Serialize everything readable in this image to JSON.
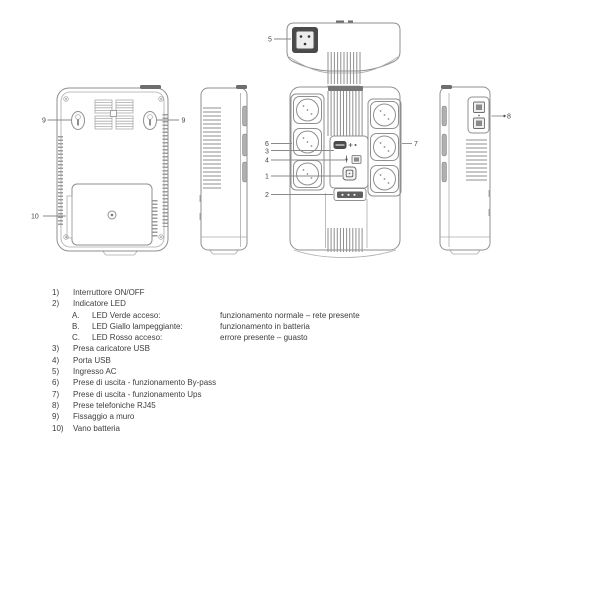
{
  "page": {
    "background": "#ffffff",
    "line_color": "#8f8f8f",
    "dark_fill": "#6e6e6e",
    "text_color": "#3e3e3e"
  },
  "callouts": {
    "power_switch": "1",
    "led_indicator": "2",
    "usb_charger": "3",
    "usb_port": "4",
    "ac_input": "5",
    "bypass_outlets": "6",
    "ups_outlets": "7",
    "rj45": "8",
    "wall_mount_left": "9",
    "wall_mount_right": "9",
    "battery_bay": "10"
  },
  "legend": {
    "items": [
      {
        "num": "1)",
        "text": "Interruttore ON/OFF"
      },
      {
        "num": "2)",
        "text": "Indicatore LED"
      },
      {
        "num": "3)",
        "text": "Presa caricatore USB"
      },
      {
        "num": "4)",
        "text": "Porta USB"
      },
      {
        "num": "5)",
        "text": "Ingresso AC"
      },
      {
        "num": "6)",
        "text": "Prese di uscita - funzionamento By-pass"
      },
      {
        "num": "7)",
        "text": "Prese di uscita - funzionamento Ups"
      },
      {
        "num": "8)",
        "text": "Prese telefoniche RJ45"
      },
      {
        "num": "9)",
        "text": "Fissaggio a muro"
      },
      {
        "num": "10)",
        "text": "Vano batteria"
      }
    ],
    "led_states": [
      {
        "letter": "A.",
        "label": "LED Verde acceso:",
        "desc": "funzionamento normale – rete presente"
      },
      {
        "letter": "B.",
        "label": "LED Giallo lampeggiante:",
        "desc": "funzionamento in batteria"
      },
      {
        "letter": "C.",
        "label": "LED Rosso acceso:",
        "desc": "errore presente – guasto"
      }
    ]
  }
}
